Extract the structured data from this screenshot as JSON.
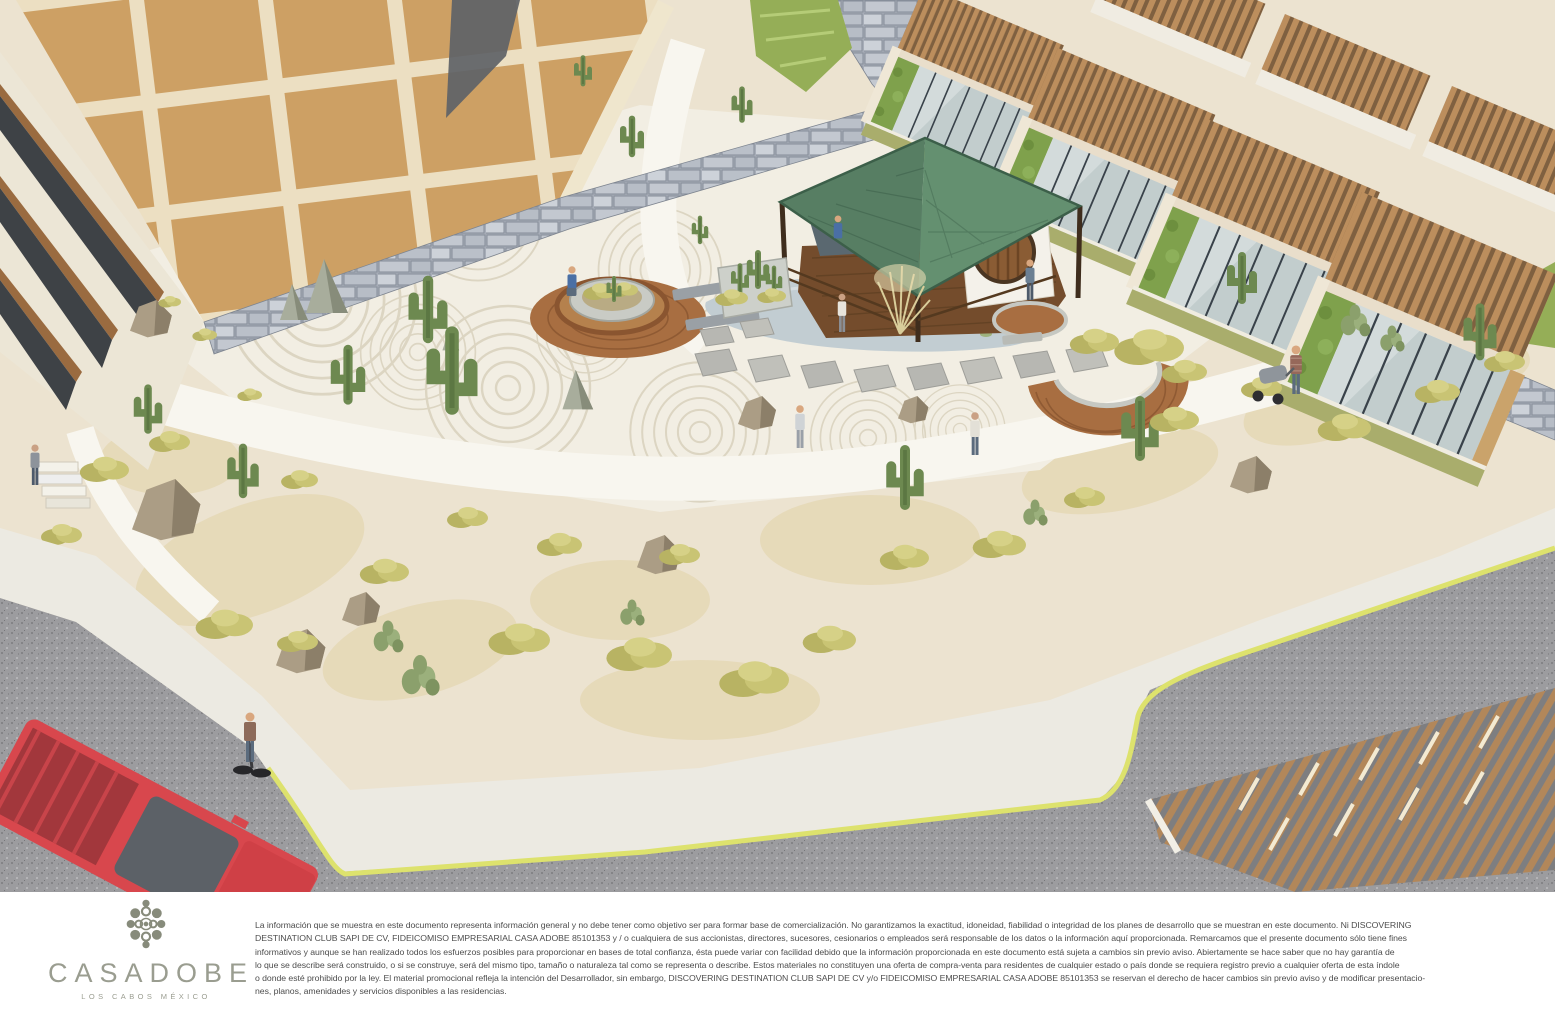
{
  "rendering": {
    "description": "Aerial 3D architectural rendering of the Casadobe zen garden courtyard: a green hip-roof tea pavilion with a circular moon window beside a reflecting pond, raked-gravel zen circles with boulders and cacti, stone retaining walls, an adobe-brick residential building on the left, terraced residences with wood-slat pergolas and glass fronts on the right, curved wooden decks and benches, desert landscaping with saguaros and olive shrubs, walking paths with visitors, a road with a red pickup truck, a person on a Segway and a slatted parking canopy at lower right.",
    "palette": {
      "roof_green": "#5e8a6e",
      "adobe_tan": "#cfa165",
      "stone_gray": "#bcc1c9",
      "deck_wood": "#a86e41",
      "pergola_wood": "#bb8d5c",
      "desert_sand": "#ece3d0",
      "shrub_olive": "#c2bd6f",
      "accent_chartreuse": "#dde26d",
      "truck_red": "#d8474d",
      "pond_gray_blue": "#c2cdd2"
    }
  },
  "footer": {
    "logo": {
      "name": "CASADOBE",
      "tagline": "LOS CABOS MÉXICO",
      "color": "#9a9d90"
    },
    "disclaimer": {
      "lines": [
        "La información que se muestra en este documento representa información general y no debe tener como objetivo ser para formar base de comercialización. No garantizamos la exactitud, idoneidad, fiabilidad o integridad de los planes de desarrollo que se muestran en este documento.  Ni DISCOVERING",
        "DESTINATION CLUB SAPI DE CV, FIDEICOMISO EMPRESARIAL CASA ADOBE 85101353 y / o cualquiera de sus accionistas, directores, sucesores, cesionarios o empleados será responsable de los datos o la información aquí proporcionada. Remarcamos que el presente documento sólo tiene fines",
        "informativos y aunque se han realizado todos los esfuerzos posibles para proporcionar en bases de total confianza, ésta puede variar con facilidad debido que la información proporcionada en este documento está sujeta a cambios sin previo aviso. Abiertamente se hace saber que no hay garantía de",
        "lo que se describe será construido, o si se construye, será del mismo tipo, tamaño o naturaleza tal como se representa o describe.  Estos materiales no constituyen una oferta de compra-venta para residentes de cualquier estado o país donde se requiera registro previo a cualquier oferta de esta índole",
        "o donde esté prohibido por la ley. El material promocional refleja la intención del Desarrollador, sin embargo, DISCOVERING DESTINATION CLUB SAPI DE CV y/o FIDEICOMISO EMPRESARIAL CASA ADOBE 85101353 se reservan el derecho de hacer cambios sin previo aviso y de modificar presentacio-",
        "nes, planos, amenidades y servicios disponibles a las residencias."
      ]
    }
  }
}
